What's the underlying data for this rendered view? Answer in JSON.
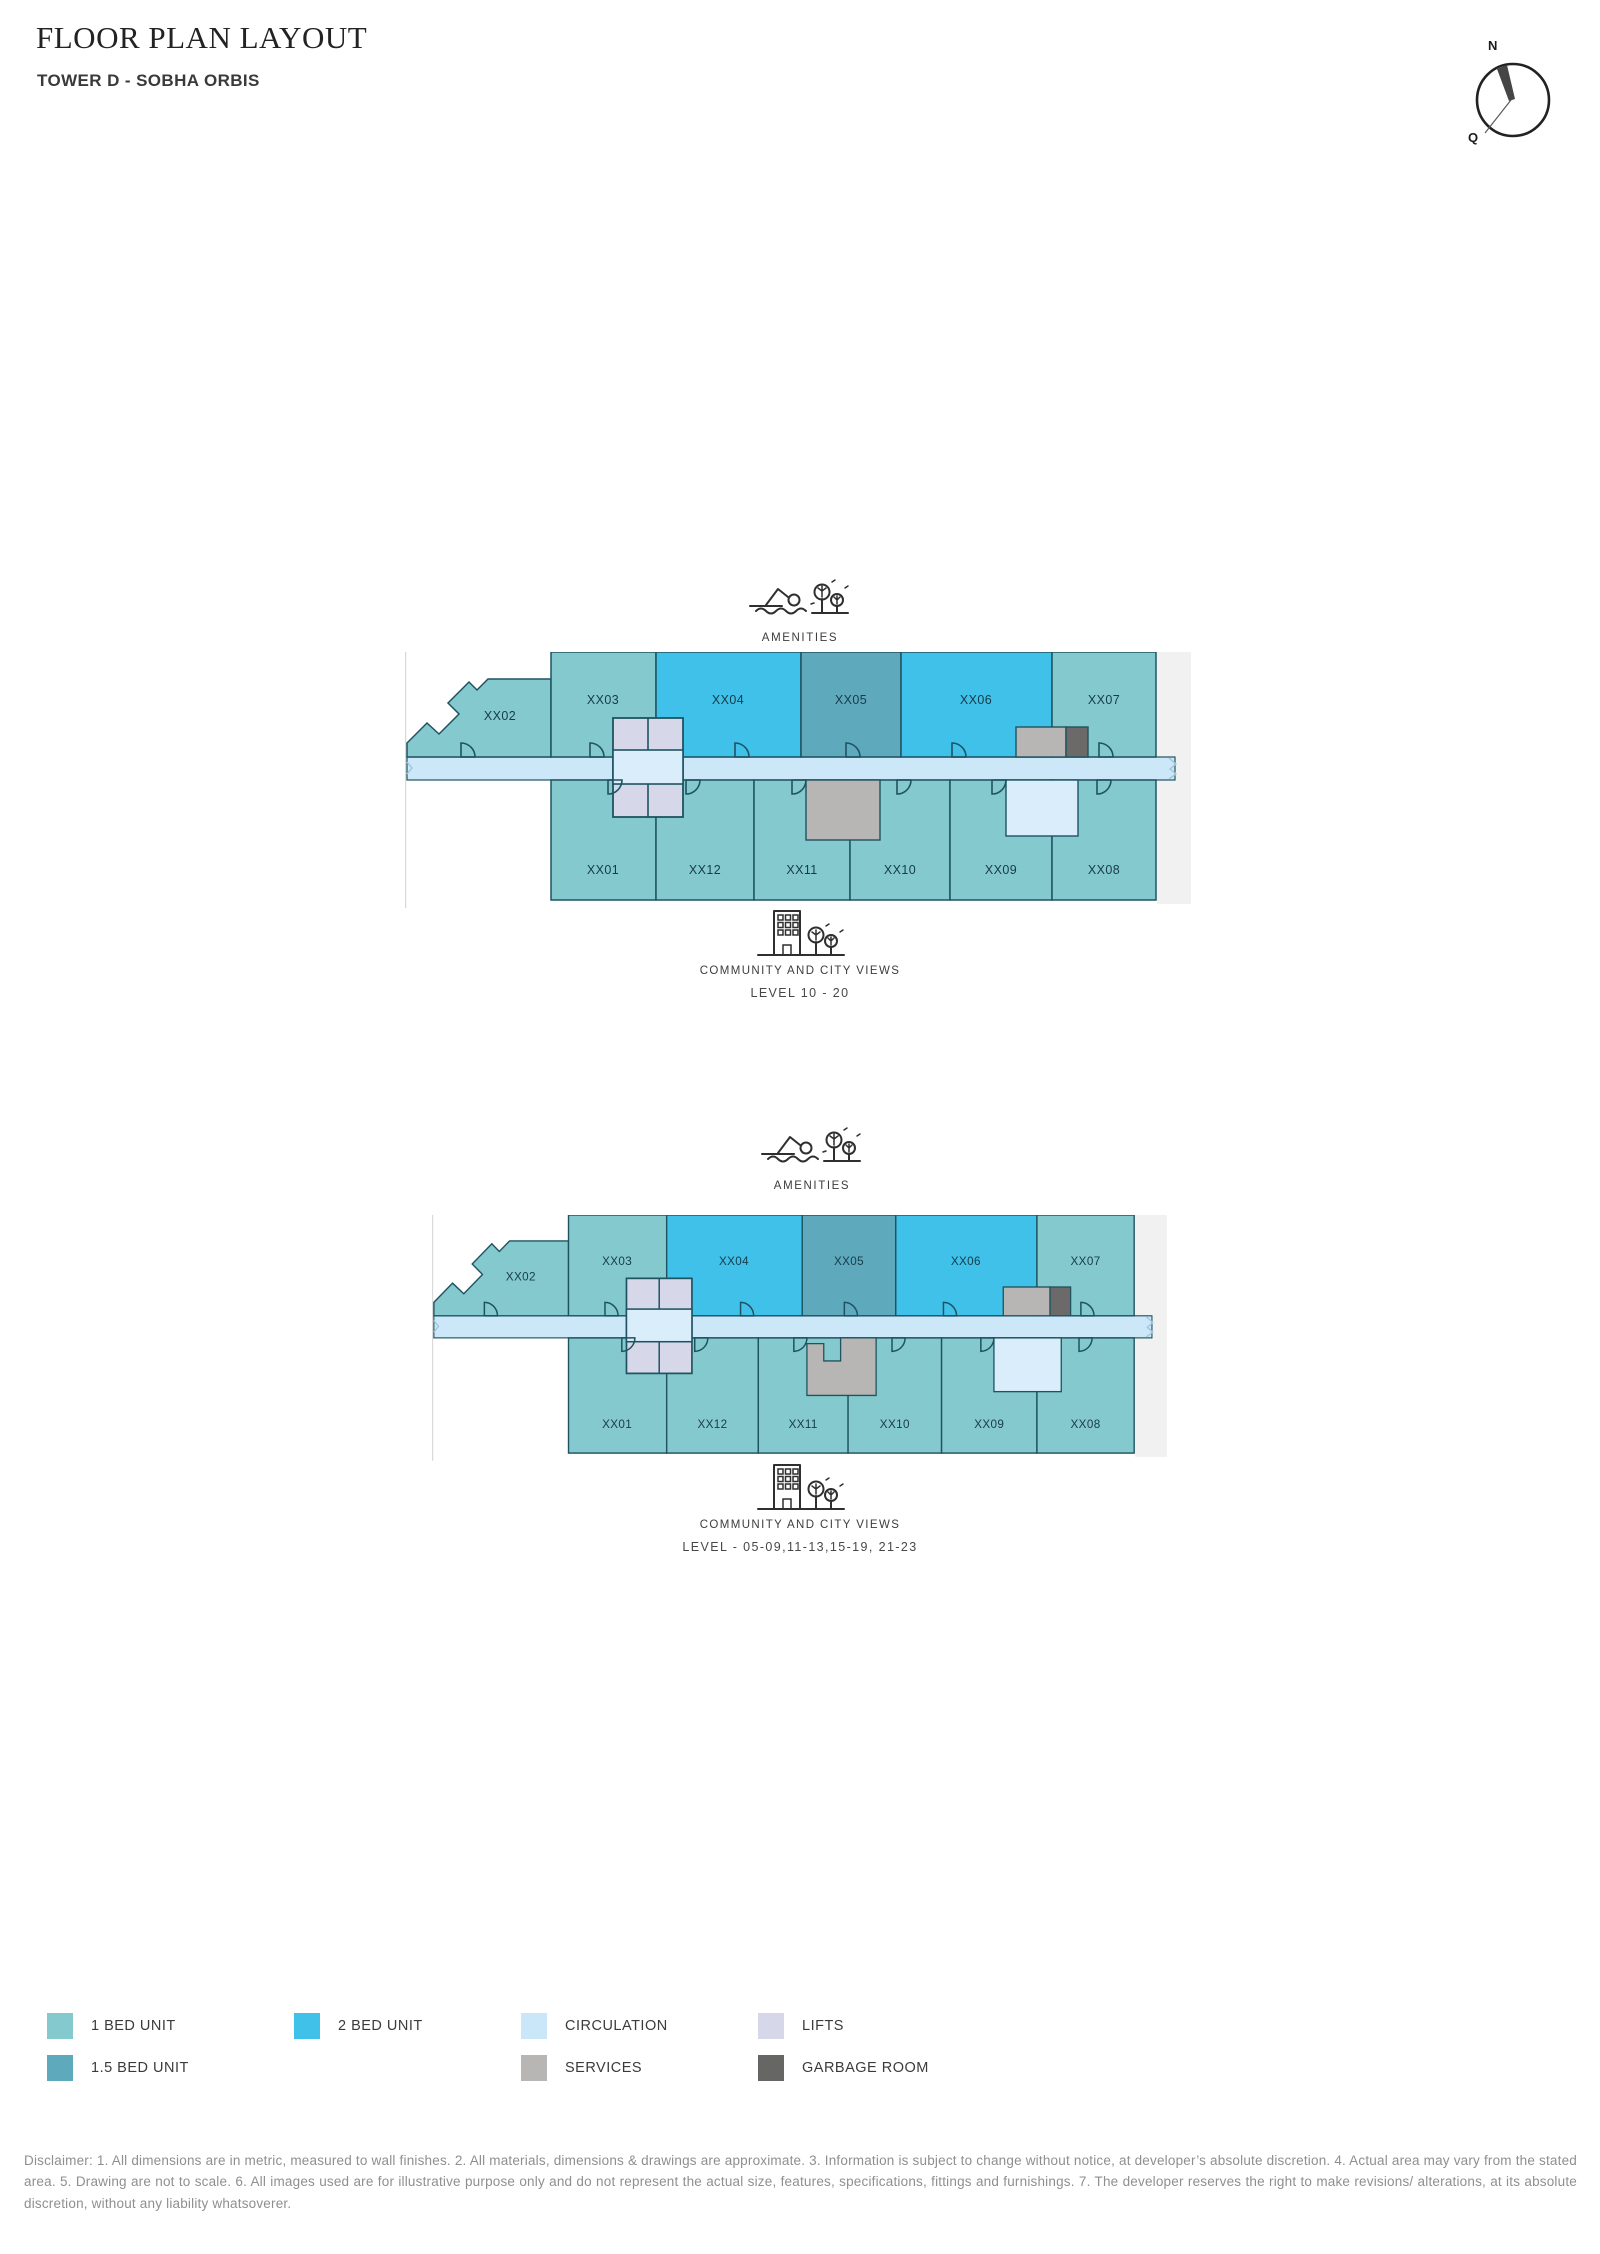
{
  "header": {
    "title": "FLOOR PLAN LAYOUT",
    "subtitle": "TOWER D - SOBHA ORBIS"
  },
  "compass": {
    "north": "N",
    "south": "Q"
  },
  "colors": {
    "one_bed": "#84c9cd",
    "one_half_bed": "#5fa9bd",
    "two_bed": "#3fc1e9",
    "circulation": "#cbe7f8",
    "circulation_light": "#d9edfb",
    "lifts": "#d6d8ea",
    "services": "#b7b6b4",
    "garbage": "#6b6a68",
    "outline": "#1f5361",
    "side_strip": "#f1f1f1",
    "frame_line": "#d9d9d9",
    "break_mark": "#9fc6dd"
  },
  "plans": [
    {
      "amenities_label": "AMENITIES",
      "views_label": "COMMUNITY AND CITY VIEWS",
      "level_label": "LEVEL 10 - 20",
      "top_units": [
        "XX02",
        "XX03",
        "XX04",
        "XX05",
        "XX06",
        "XX07"
      ],
      "bottom_units": [
        "XX01",
        "XX12",
        "XX11",
        "XX10",
        "XX09",
        "XX08"
      ]
    },
    {
      "amenities_label": "AMENITIES",
      "views_label": "COMMUNITY AND CITY VIEWS",
      "level_label": "LEVEL - 05-09,11-13,15-19, 21-23",
      "top_units": [
        "XX02",
        "XX03",
        "XX04",
        "XX05",
        "XX06",
        "XX07"
      ],
      "bottom_units": [
        "XX01",
        "XX12",
        "XX11",
        "XX10",
        "XX09",
        "XX08"
      ]
    }
  ],
  "legend": {
    "items": [
      {
        "label": "1 BED UNIT",
        "color": "#84c9cd"
      },
      {
        "label": "2 BED UNIT",
        "color": "#3fc1e9"
      },
      {
        "label": "CIRCULATION",
        "color": "#c9e7f8"
      },
      {
        "label": "LIFTS",
        "color": "#d6d8ea"
      },
      {
        "label": "1.5 BED UNIT",
        "color": "#5fa9bd"
      },
      {
        "label": "SERVICES",
        "color": "#b7b6b4"
      },
      {
        "label": "GARBAGE ROOM",
        "color": "#666664"
      }
    ]
  },
  "disclaimer": "Disclaimer: 1. All dimensions are in metric, measured to wall finishes. 2. All materials, dimensions & drawings are approximate. 3. Information is subject to change without notice, at developer’s absolute discretion. 4. Actual area may vary from the stated area. 5. Drawing are not to scale. 6. All images used are for illustrative purpose only and do not represent the actual size, features, specifications, fittings and furnishings. 7. The developer reserves the right to make revisions/ alterations, at its absolute discretion, without any liability whatsoverer."
}
